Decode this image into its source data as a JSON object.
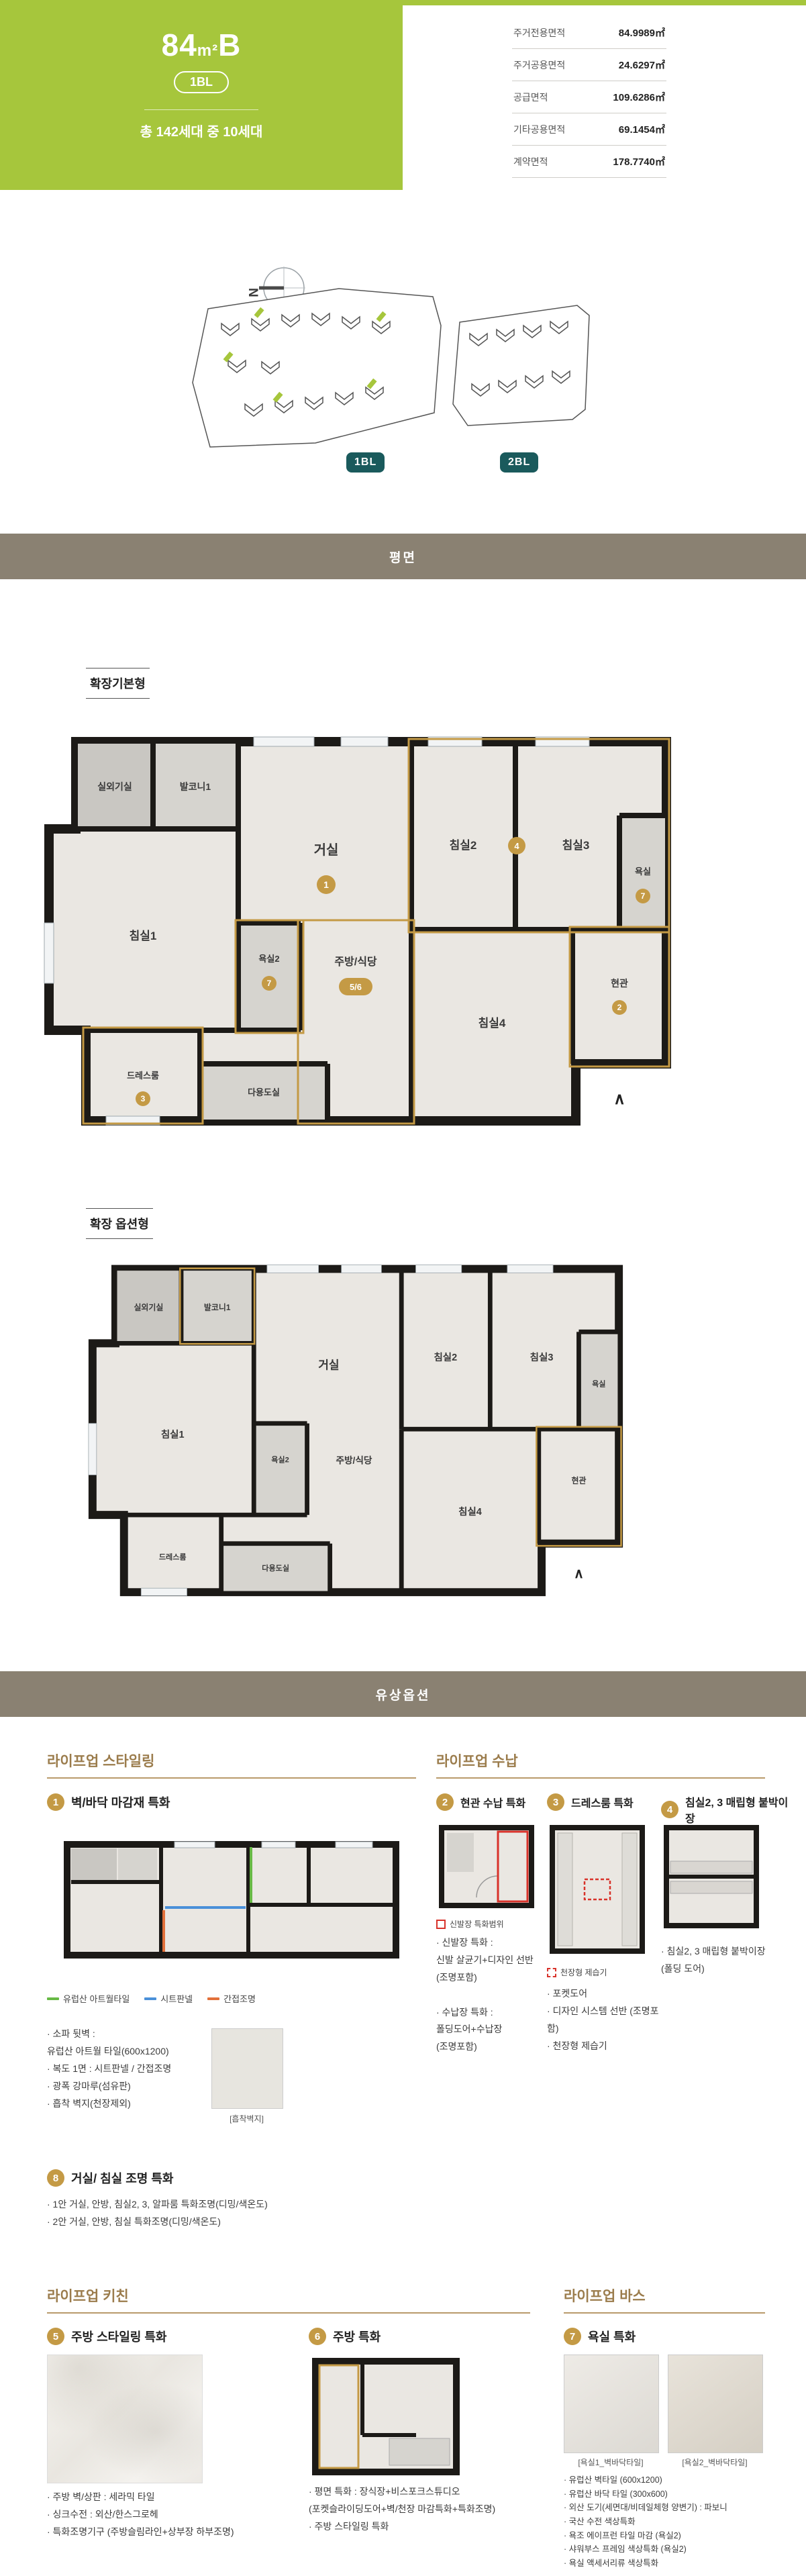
{
  "colors": {
    "green": "#a6c63c",
    "teal": "#1a5a5c",
    "bar": "#8a8172",
    "gold": "#c49a45",
    "bronze": "#9b7c4c",
    "bronzeLine": "#b99a6b",
    "wall": "#1c1a17",
    "room": "#eae7e2",
    "roomGray": "#c9c7c2",
    "roomLGray": "#d6d4cf",
    "red": "#d8322a",
    "legendGreen": "#67b945",
    "legendBlue": "#4a90d9",
    "legendOrange": "#e2703a"
  },
  "header": {
    "title_num": "84",
    "title_unit": "m²",
    "title_suffix": "B",
    "block_badge": "1BL",
    "units_text": "총 142세대 중 10세대",
    "area_table": {
      "rows": [
        {
          "label": "주거전용면적",
          "value": "84.9989㎡"
        },
        {
          "label": "주거공용면적",
          "value": "24.6297㎡"
        },
        {
          "label": "공급면적",
          "value": "109.6286㎡"
        },
        {
          "label": "기타공용면적",
          "value": "69.1454㎡"
        },
        {
          "label": "계약면적",
          "value": "178.7740㎡"
        }
      ]
    }
  },
  "site_plan": {
    "compass_label": "N",
    "badge1": "1BL",
    "badge2": "2BL"
  },
  "section_bars": {
    "plan": "평면",
    "paid_options": "유상옵션"
  },
  "plan_basic": {
    "label": "확장기본형",
    "rooms": {
      "outdoor_unit": "실외기실",
      "balcony1": "발코니1",
      "bedroom1": "침실1",
      "living": "거실",
      "bedroom2": "침실2",
      "bedroom3": "침실3",
      "bath": "욕실",
      "bath2": "욕실2",
      "kitchen": "주방/식당",
      "bedroom4": "침실4",
      "entry": "현관",
      "dress_room": "드레스룸",
      "utility": "다용도실"
    },
    "markers": {
      "living": "1",
      "entry": "2",
      "dress": "3",
      "bed23": "4",
      "kitchen": "5/6",
      "bath": "7",
      "bath2": "7"
    },
    "entry_arrow": "∧"
  },
  "plan_option": {
    "label": "확장 옵션형",
    "rooms": {
      "outdoor_unit": "실외기실",
      "balcony1": "발코니1",
      "bedroom1": "침실1",
      "living": "거실",
      "bedroom2": "침실2",
      "bedroom3": "침실3",
      "bath": "욕실",
      "bath2": "욕실2",
      "kitchen": "주방/식당",
      "bedroom4": "침실4",
      "entry": "현관",
      "dress_room": "드레스룸",
      "utility": "다용도실"
    },
    "entry_arrow": "∧"
  },
  "options": {
    "styling": {
      "header": "라이프업 스타일링",
      "item1": {
        "num": "1",
        "title": "벽/바닥 마감재 특화",
        "legend": [
          {
            "label": "유럽산 아트월타일"
          },
          {
            "label": "시트판넬"
          },
          {
            "label": "간접조명"
          }
        ],
        "bullets": "· 소파 뒷벽 :\n  유럽산 아트월 타일(600x1200)\n· 복도 1면 : 시트판넬 / 간접조명\n· 광폭 강마루(섬유판)\n· 흡착 벽지(천장제외)",
        "swatch_caption": "[흡착벽지]"
      },
      "item8": {
        "num": "8",
        "title": "거실/ 침실 조명 특화",
        "bullets": "· 1안 거실, 안방, 침실2, 3, 알파룸 특화조명(디밍/색온도)\n· 2안 거실, 안방, 침실 특화조명(디밍/색온도)"
      }
    },
    "storage": {
      "header": "라이프업 수납",
      "item2": {
        "num": "2",
        "title": "현관 수납 특화",
        "legend": "신발장 특화범위",
        "bullets": "· 신발장 특화 :\n  신발 살균기+디자인 선반\n  (조명포함)\n\n· 수납장 특화 :\n  폴딩도어+수납장\n  (조명포함)"
      },
      "item3": {
        "num": "3",
        "title": "드레스룸 특화",
        "legend": "천장형 제습기",
        "bullets": "· 포켓도어\n· 디자인 시스템 선반 (조명포함)\n· 천장형 제습기"
      },
      "item4": {
        "num": "4",
        "title": "침실2, 3 매립형 붙박이장",
        "bullets": "· 침실2, 3 매립형 붙박이장\n  (폴딩 도어)"
      }
    },
    "kitchen": {
      "header": "라이프업 키친",
      "item5": {
        "num": "5",
        "title": "주방 스타일링 특화",
        "bullets": "· 주방 벽/상판 : 세라믹 타일\n· 싱크수전 : 외산/한스그로헤\n· 특화조명기구 (주방슬림라인+상부장 하부조명)"
      },
      "item6": {
        "num": "6",
        "title": "주방 특화",
        "bullets": "· 평면 특화 : 장식장+비스포크스튜디오\n  (포켓슬라이딩도어+벽/천장 마감특화+특화조명)\n· 주방 스타일링 특화"
      }
    },
    "bath": {
      "header": "라이프업 바스",
      "item7": {
        "num": "7",
        "title": "욕실 특화",
        "tile_caption1": "[욕실1_벽바닥타일]",
        "tile_caption2": "[욕실2_벽바닥타일]",
        "bullets": "· 유럽산 벽타일 (600x1200)\n· 유럽산 바닥 타일 (300x600)\n· 외산 도기(세면대/비데일체형 양변기) : 파보니\n· 국산 수전 색상특화\n· 욕조 에이프런 타일 마감 (욕실2)\n· 샤워부스 프레임 색상특화 (욕실2)\n· 욕실 액세서리류 색상특화"
      }
    }
  }
}
